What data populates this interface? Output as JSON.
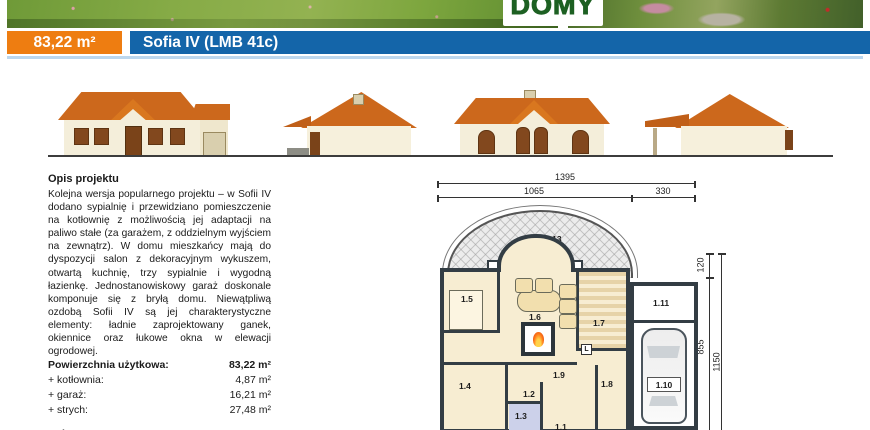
{
  "header": {
    "logo_text": "DOMY"
  },
  "title_bar": {
    "area_badge": "83,22 m²",
    "project_title": "Sofia IV (LMB 41c)"
  },
  "colors": {
    "accent_orange": "#ee7d11",
    "brand_blue": "#1465a9",
    "underline_blue": "#bcd7ee"
  },
  "description": {
    "heading": "Opis projektu",
    "body": "Kolejna wersja popularnego projektu – w Sofii IV dodano sypialnię i przewidziano pomieszczenie na kotłownię z możliwością jej adaptacji na paliwo stałe (za garażem, z oddzielnym wyjściem na zewnątrz). W domu mieszkańcy mają do dyspozycji salon z dekoracyjnym wykuszem, otwartą kuchnię, trzy sypialnie i wygodną łazienkę. Jednostanowiskowy garaż doskonale komponuje się z bryłą domu. Niewątpliwą ozdobą Sofii IV są jej charakterystyczne elementy: ładnie zaprojektowany ganek, okiennice oraz łukowe okna w elewacji ogrodowej."
  },
  "areas_table": {
    "rows": [
      {
        "label": "Powierzchnia użytkowa:",
        "value": "83,22 m²"
      },
      {
        "label": "+ kotłownia:",
        "value": "4,87 m²"
      },
      {
        "label": "+ garaż:",
        "value": "16,21 m²"
      },
      {
        "label": "+ strych:",
        "value": "27,48 m²"
      },
      {
        "label": "Kubatura:",
        "value": "524,00 m³"
      }
    ]
  },
  "floor_plan": {
    "dims_top": {
      "total": "1395",
      "left": "1065",
      "right": "330"
    },
    "dims_right": {
      "top": "120",
      "middle": "855",
      "total": "1150"
    },
    "room_labels": {
      "terrace": "1.13",
      "bedroom1": "1.5",
      "living": "1.6",
      "kitchen": "1.7",
      "boiler": "1.11",
      "garage": "1.10",
      "bedroom2": "1.4",
      "hall": "1.2",
      "bath": "1.3",
      "corridor": "1.9",
      "bedroom3": "1.8",
      "entry": "1.1",
      "fridge": "L"
    }
  }
}
